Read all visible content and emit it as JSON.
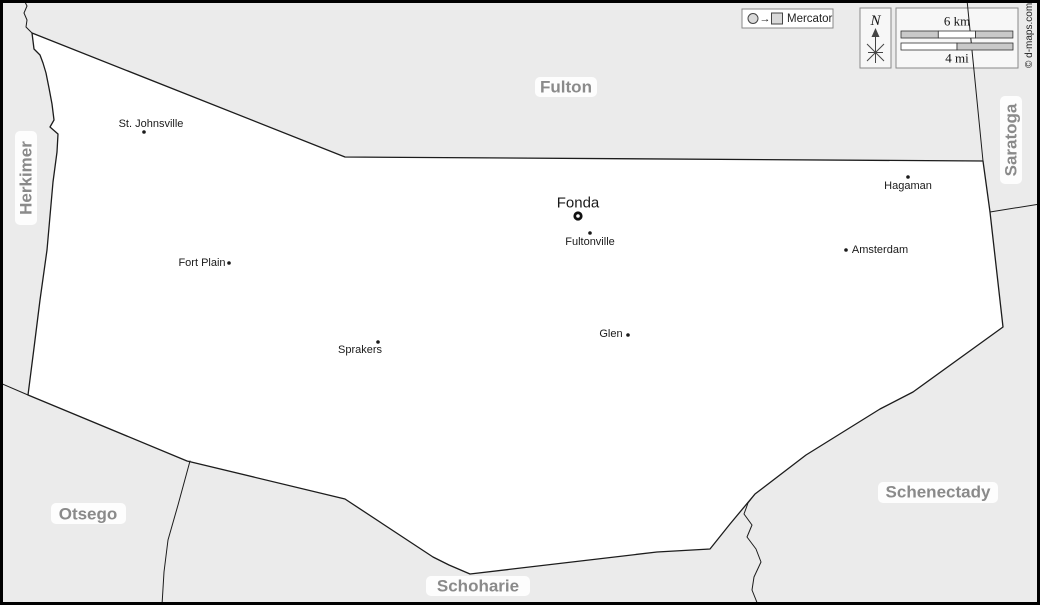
{
  "legend": {
    "projection": "Mercator"
  },
  "compass": {
    "north_label": "N"
  },
  "scale_bar": {
    "km": "6 km",
    "mi": "4 mi"
  },
  "copyright": "© d-maps.com",
  "counties": [
    {
      "id": "herkimer",
      "name": "Herkimer"
    },
    {
      "id": "fulton",
      "name": "Fulton"
    },
    {
      "id": "saratoga",
      "name": "Saratoga"
    },
    {
      "id": "schenectady",
      "name": "Schenectady"
    },
    {
      "id": "otsego",
      "name": "Otsego"
    },
    {
      "id": "schoharie",
      "name": "Schoharie"
    }
  ],
  "towns": [
    {
      "name": "St. Johnsville",
      "type": "town"
    },
    {
      "name": "Fort Plain",
      "type": "town"
    },
    {
      "name": "Sprakers",
      "type": "town"
    },
    {
      "name": "Fonda",
      "type": "county-seat"
    },
    {
      "name": "Fultonville",
      "type": "town"
    },
    {
      "name": "Glen",
      "type": "town"
    },
    {
      "name": "Amsterdam",
      "type": "town"
    },
    {
      "name": "Hagaman",
      "type": "town"
    }
  ],
  "colors": {
    "background": "#ebebeb",
    "county_fill": "#ffffff",
    "boundary": "#1c1c1c",
    "county_label": "#8a8a8a",
    "town_label": "#1a1a1a",
    "scale_segment": "#c9c9c9"
  }
}
